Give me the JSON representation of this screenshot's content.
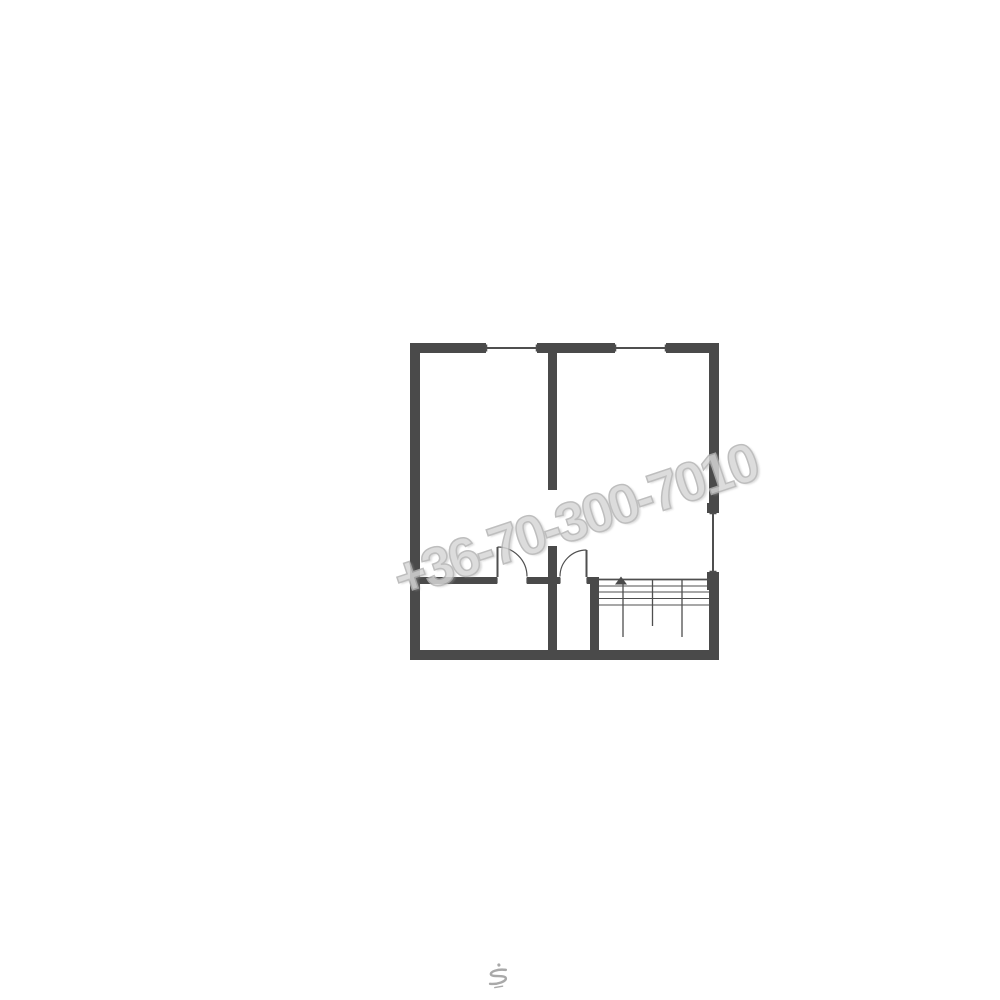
{
  "colors": {
    "wall": "#4a4a4a",
    "line": "#4f4f4f",
    "watermark": "#d6d6d6",
    "watermark-stroke": "#b3b3b3",
    "logo": "#a9a9a9",
    "bg": "#ffffff"
  },
  "watermark": {
    "text": "+36-70-300-7010"
  },
  "logo": {
    "icon": "s-monogram-icon"
  },
  "floorplan": {
    "type": "architectural-floor-plan",
    "rooms": 4,
    "doors": 2,
    "windows": 3,
    "staircase": {
      "location": "bottom-right",
      "tread_lines": 4,
      "direction": "up"
    }
  }
}
